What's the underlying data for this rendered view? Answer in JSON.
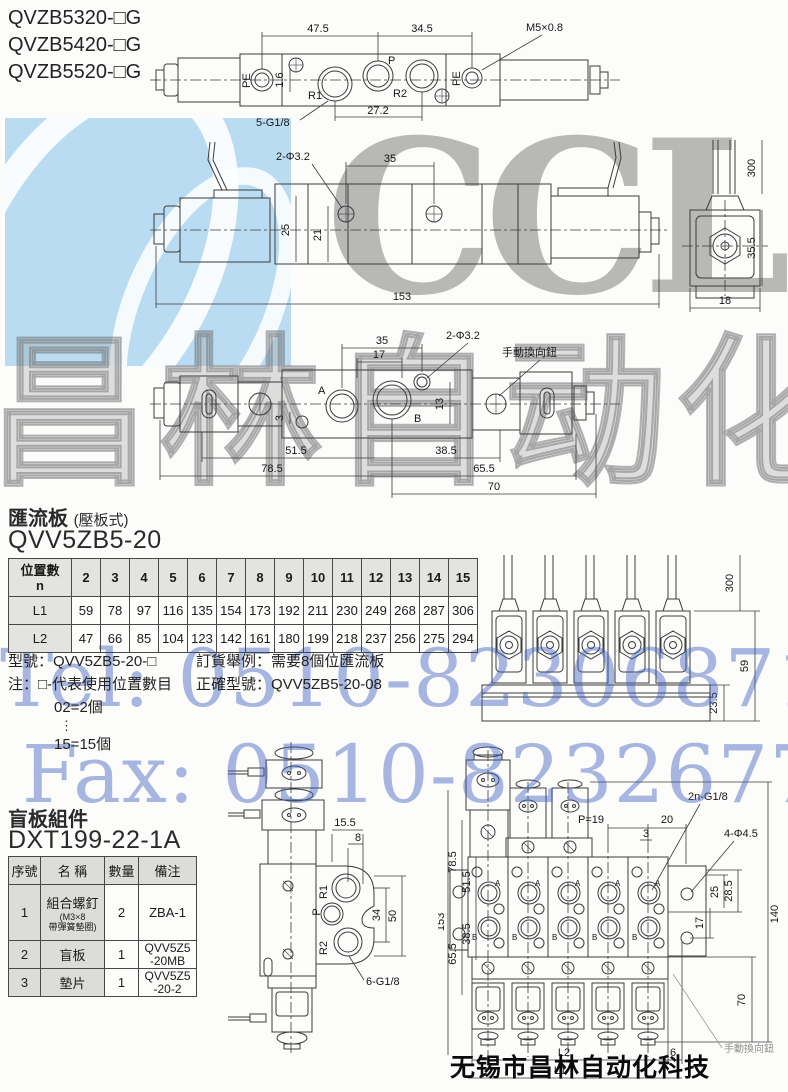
{
  "header": {
    "models": [
      "QVZB5320-□G",
      "QVZB5420-□G",
      "QVZB5520-□G"
    ]
  },
  "watermarks": {
    "logo_text": "CCLair",
    "cn_text": "昌林自动化",
    "tel_text": "Tel: 0510-82306871",
    "fax_text": "Fax: 0510-82326771",
    "footer_text": "无锡市昌林自动化科技",
    "logo_blue": "#badcf2",
    "watermark_blue": "#4062be",
    "watermark_gray": "#969696"
  },
  "top_view": {
    "dim_47_5": "47.5",
    "dim_34_5": "34.5",
    "thread_label": "M5×0.8",
    "pe_left": "PE",
    "pe_right": "PE",
    "port_p": "P",
    "port_r1": "R1",
    "port_r2": "R2",
    "dim_1_6": "1.6",
    "ports_label": "5-G1/8",
    "dim_27_2": "27.2"
  },
  "side_view": {
    "holes_label": "2-Φ3.2",
    "dim_35": "35",
    "dim_25": "25",
    "dim_21": "21",
    "dim_153": "153",
    "dim_300": "300",
    "dim_35_5": "35.5",
    "dim_18": "18"
  },
  "bottom_view": {
    "dim_35": "35",
    "dim_17": "17",
    "holes_label": "2-Φ3.2",
    "manual_label": "手動換向鈕",
    "port_a": "A",
    "port_b": "B",
    "dim_3": "3",
    "dim_13": "13",
    "dim_51_5": "51.5",
    "dim_38_5": "38.5",
    "dim_78_5": "78.5",
    "dim_65_5": "65.5",
    "dim_70": "70"
  },
  "manifold": {
    "title": "匯流板",
    "title_note": "(壓板式)",
    "model": "QVV5ZB5-20",
    "table": {
      "corner_line1": "位置數",
      "corner_line2": "n",
      "l1_label": "L1",
      "l2_label": "L2",
      "positions": [
        "2",
        "3",
        "4",
        "5",
        "6",
        "7",
        "8",
        "9",
        "10",
        "11",
        "12",
        "13",
        "14",
        "15"
      ],
      "l1": [
        "59",
        "78",
        "97",
        "116",
        "135",
        "154",
        "173",
        "192",
        "211",
        "230",
        "249",
        "268",
        "287",
        "306"
      ],
      "l2": [
        "47",
        "66",
        "85",
        "104",
        "123",
        "142",
        "161",
        "180",
        "199",
        "218",
        "237",
        "256",
        "275",
        "294"
      ]
    },
    "note_model": "型號：QVV5ZB5-20-□",
    "note_line2": "注：□-代表使用位置數目",
    "note_line3": "02=2個",
    "note_dots": "⋮",
    "note_line4": "15=15個",
    "order_line1": "訂貨舉例：需要8個位匯流板",
    "order_line2": "正確型號：QVV5ZB5-20-08",
    "front_view": {
      "dim_300": "300",
      "dim_59": "59",
      "dim_23_5": "23.5"
    }
  },
  "blank_plate": {
    "title": "盲板組件",
    "model": "DXT199-22-1A",
    "table": {
      "h_no": "序號",
      "h_name": "名 稱",
      "h_qty": "數量",
      "h_remark": "備注",
      "rows": [
        {
          "no": "1",
          "name": "組合螺釘",
          "sub1": "(M3×8",
          "sub2": "帶彈簧墊圈)",
          "qty": "2",
          "remark": "ZBA-1",
          "remark2": ""
        },
        {
          "no": "2",
          "name": "盲板",
          "sub1": "",
          "sub2": "",
          "qty": "1",
          "remark": "QVV5Z5",
          "remark2": "-20MB"
        },
        {
          "no": "3",
          "name": "墊片",
          "sub1": "",
          "sub2": "",
          "qty": "1",
          "remark": "QVV5Z5",
          "remark2": "-20-2"
        }
      ]
    }
  },
  "valve_side": {
    "dim_15_5": "15.5",
    "dim_8": "8",
    "port_r1": "R1",
    "port_p": "P",
    "port_r2": "R2",
    "dim_34": "34",
    "dim_50": "50",
    "ports_label": "6-G1/8"
  },
  "manifold_top": {
    "label_2n": "2n-G1/8",
    "label_p19": "P=19",
    "dim_20": "20",
    "dim_3": "3",
    "label_4holes": "4-Φ4.5",
    "dim_153": "153",
    "dim_78_5": "78.5",
    "dim_51_5": "51.5",
    "dim_38_5": "38.5",
    "dim_65_5": "65.5",
    "dim_25": "25",
    "dim_28_5": "28.5",
    "dim_17": "17",
    "dim_140": "140",
    "dim_70": "70",
    "dim_l2": "L2",
    "dim_l1": "L1",
    "dim_6": "6",
    "manual_label": "手動換向鈕",
    "port_a": "A",
    "port_b": "B"
  }
}
